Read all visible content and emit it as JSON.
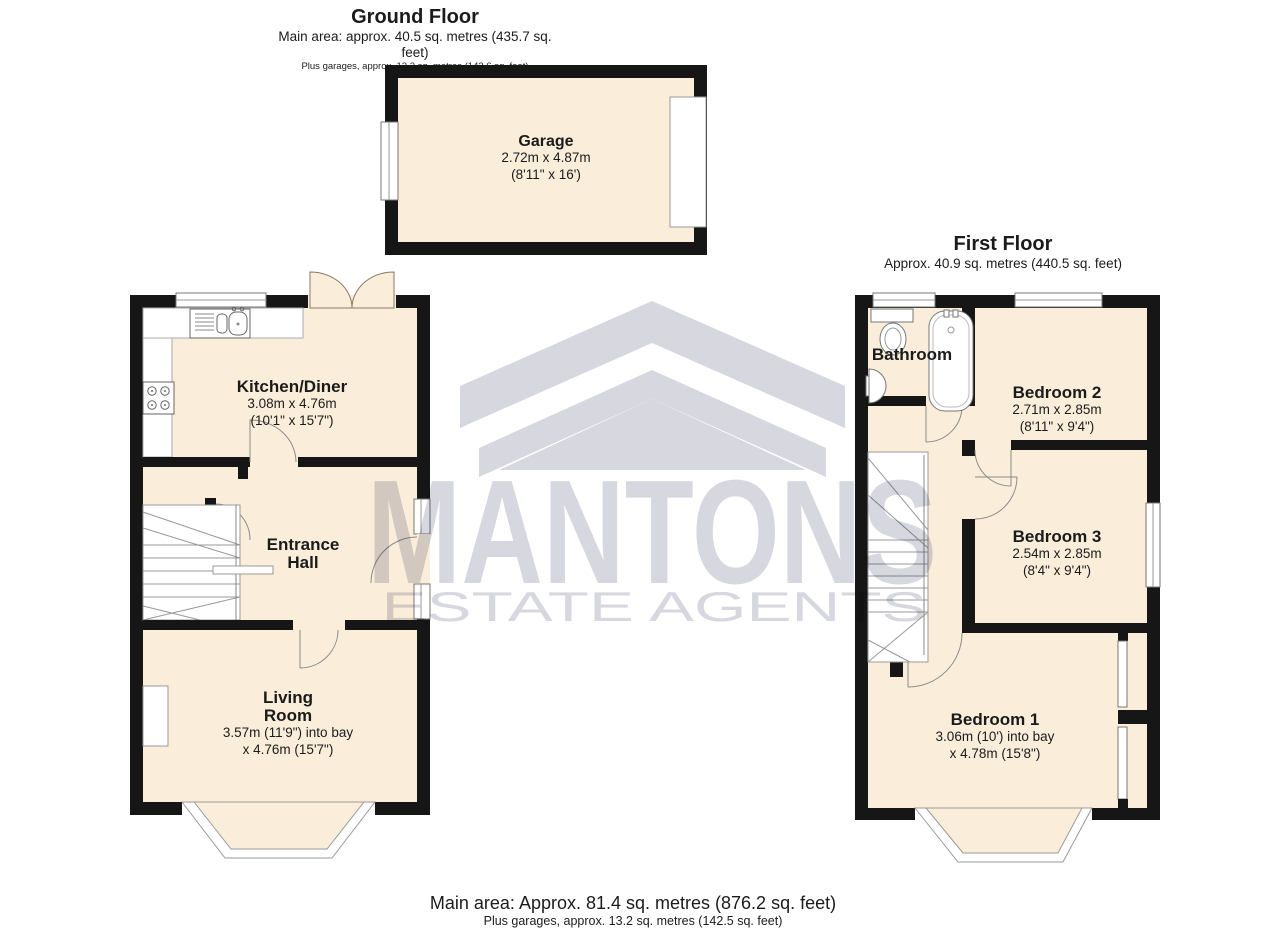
{
  "ground_floor": {
    "title": "Ground Floor",
    "area_line": "Main area: approx. 40.5 sq. metres (435.7 sq. feet)",
    "garage_line": "Plus garages, approx. 13.2 sq. metres (142.6 sq. feet)",
    "rooms": {
      "garage": {
        "name": "Garage",
        "metric": "2.72m x 4.87m",
        "imperial": "(8'11\" x 16')"
      },
      "kitchen": {
        "name": "Kitchen/Diner",
        "metric": "3.08m x 4.76m",
        "imperial": "(10'1\" x 15'7\")"
      },
      "entrance_hall": {
        "line1": "Entrance",
        "line2": "Hall"
      },
      "living_room": {
        "line1": "Living",
        "line2": "Room",
        "dims1": "3.57m (11'9\") into bay",
        "dims2": "x 4.76m (15'7\")"
      }
    }
  },
  "first_floor": {
    "title": "First Floor",
    "area_line": "Approx. 40.9 sq. metres (440.5 sq. feet)",
    "rooms": {
      "bathroom": {
        "name": "Bathroom"
      },
      "bedroom2": {
        "name": "Bedroom 2",
        "metric": "2.71m x 2.85m",
        "imperial": "(8'11\" x 9'4\")"
      },
      "bedroom3": {
        "name": "Bedroom 3",
        "metric": "2.54m x 2.85m",
        "imperial": "(8'4\" x 9'4\")"
      },
      "bedroom1": {
        "name": "Bedroom 1",
        "dims1": "3.06m (10') into bay",
        "dims2": "x 4.78m (15'8\")"
      }
    }
  },
  "footer": {
    "main_line": "Main area: Approx. 81.4 sq. metres (876.2 sq. feet)",
    "garage_line": "Plus garages, approx. 13.2 sq. metres (142.5 sq. feet)"
  },
  "watermark": {
    "name": "MANTONS",
    "tagline": "ESTATE AGENTS"
  },
  "colors": {
    "wall": "#161616",
    "room_fill": "#faeedb",
    "watermark": "#d7d7e0",
    "fixture_stroke": "#777777"
  }
}
